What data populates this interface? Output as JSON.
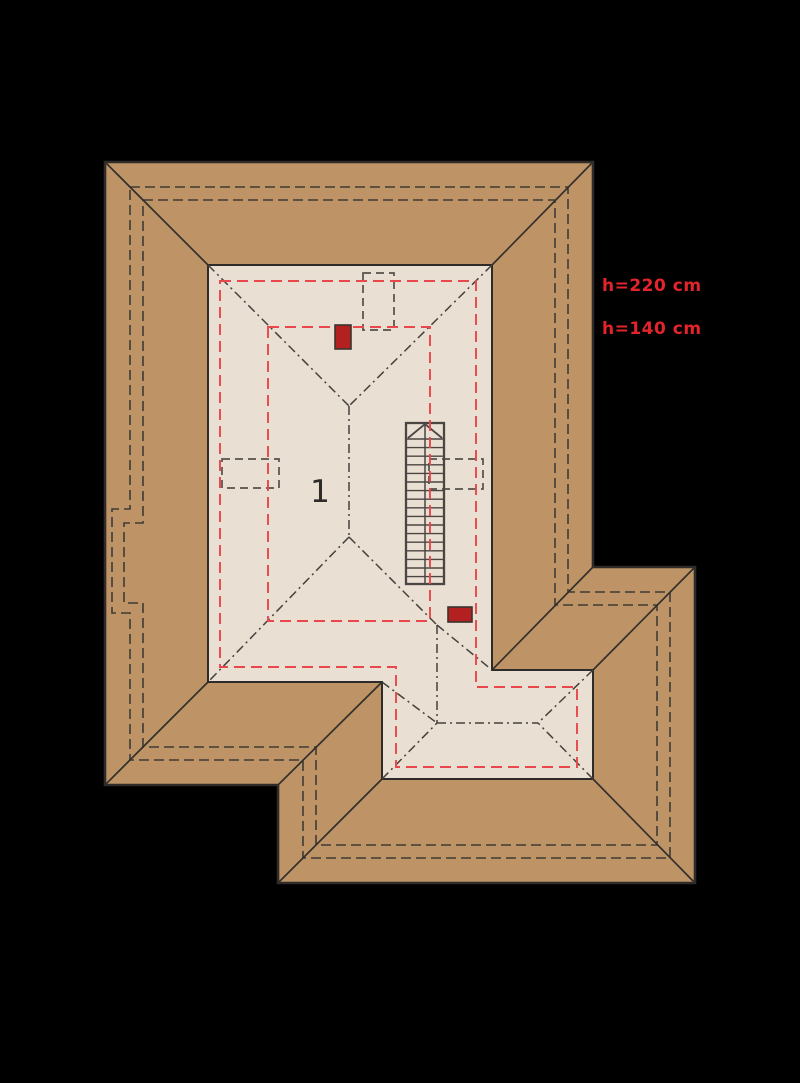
{
  "title": "Attic roof-level floor plan",
  "canvas": {
    "width": 800,
    "height": 1083,
    "background": "#000000"
  },
  "colors": {
    "roof_fill": "#BE9466",
    "floor_fill": "#EADFD3",
    "outline": "#2E2B28",
    "hip_line": "#33302C",
    "wall_dash": "#3E3B37",
    "ridge_dash": "#45413C",
    "window_dash": "#53504B",
    "height_line": "#E8474B",
    "annotation_text": "#E3242B",
    "room_label": "#2E2B28",
    "chimney_fill": "#B2211F",
    "chimney_stroke": "#3A3530",
    "stair_stroke": "#4A4642"
  },
  "annotations": {
    "height_upper": "h=220 cm",
    "height_lower": "h=140 cm",
    "room_number": "1"
  },
  "geometry": {
    "roof_outline": [
      [
        105,
        162
      ],
      [
        593,
        162
      ],
      [
        593,
        567
      ],
      [
        695,
        567
      ],
      [
        695,
        883
      ],
      [
        278,
        883
      ],
      [
        278,
        785
      ],
      [
        105,
        785
      ]
    ],
    "floor_outline": [
      [
        208,
        265
      ],
      [
        492,
        265
      ],
      [
        492,
        670
      ],
      [
        593,
        670
      ],
      [
        593,
        779
      ],
      [
        382,
        779
      ],
      [
        382,
        682
      ],
      [
        208,
        682
      ]
    ],
    "wall_outline_outer": [
      [
        130,
        187
      ],
      [
        568,
        187
      ],
      [
        568,
        592
      ],
      [
        670,
        592
      ],
      [
        670,
        858
      ],
      [
        303,
        858
      ],
      [
        303,
        760
      ],
      [
        130,
        760
      ],
      [
        130,
        613
      ],
      [
        112,
        613
      ],
      [
        112,
        509
      ],
      [
        130,
        509
      ]
    ],
    "wall_outline_inner": [
      [
        143,
        200
      ],
      [
        555,
        200
      ],
      [
        555,
        605
      ],
      [
        657,
        605
      ],
      [
        657,
        845
      ],
      [
        316,
        845
      ],
      [
        316,
        747
      ],
      [
        143,
        747
      ],
      [
        143,
        603
      ],
      [
        124,
        603
      ],
      [
        124,
        523
      ],
      [
        143,
        523
      ]
    ],
    "hip_valley_lines": [
      [
        [
          105,
          162
        ],
        [
          208,
          265
        ]
      ],
      [
        [
          593,
          162
        ],
        [
          492,
          265
        ]
      ],
      [
        [
          105,
          785
        ],
        [
          208,
          682
        ]
      ],
      [
        [
          278,
          785
        ],
        [
          382,
          682
        ]
      ],
      [
        [
          278,
          883
        ],
        [
          382,
          779
        ]
      ],
      [
        [
          695,
          883
        ],
        [
          593,
          779
        ]
      ],
      [
        [
          695,
          567
        ],
        [
          593,
          670
        ]
      ],
      [
        [
          593,
          567
        ],
        [
          492,
          670
        ]
      ]
    ],
    "ridge_projection_lines": [
      [
        [
          208,
          265
        ],
        [
          349,
          406
        ]
      ],
      [
        [
          492,
          265
        ],
        [
          349,
          406
        ]
      ],
      [
        [
          349,
          406
        ],
        [
          349,
          537
        ]
      ],
      [
        [
          349,
          537
        ],
        [
          208,
          682
        ]
      ],
      [
        [
          349,
          537
        ],
        [
          437,
          625
        ]
      ],
      [
        [
          437,
          625
        ],
        [
          437,
          723
        ]
      ],
      [
        [
          437,
          625
        ],
        [
          492,
          670
        ]
      ],
      [
        [
          382,
          682
        ],
        [
          437,
          723
        ]
      ],
      [
        [
          437,
          723
        ],
        [
          538,
          723
        ]
      ],
      [
        [
          382,
          779
        ],
        [
          437,
          723
        ]
      ],
      [
        [
          593,
          670
        ],
        [
          538,
          723
        ]
      ],
      [
        [
          593,
          779
        ],
        [
          538,
          723
        ]
      ]
    ],
    "height_line_outer": [
      [
        220,
        281
      ],
      [
        476,
        281
      ],
      [
        476,
        687
      ],
      [
        577,
        687
      ],
      [
        577,
        767
      ],
      [
        396,
        767
      ],
      [
        396,
        667
      ],
      [
        220,
        667
      ]
    ],
    "height_line_inner": [
      [
        268,
        327
      ],
      [
        430,
        327
      ],
      [
        430,
        621
      ],
      [
        268,
        621
      ]
    ],
    "roof_windows": [
      {
        "x": 363,
        "y": 273,
        "w": 31,
        "h": 57
      },
      {
        "x": 222,
        "y": 459,
        "w": 57,
        "h": 29
      },
      {
        "x": 429,
        "y": 459,
        "w": 54,
        "h": 30
      }
    ],
    "chimneys": [
      {
        "x": 335,
        "y": 325,
        "w": 16,
        "h": 24
      },
      {
        "x": 448,
        "y": 607,
        "w": 24,
        "h": 15
      }
    ],
    "stair": {
      "x": 406,
      "y": 423,
      "w": 38,
      "h": 161,
      "divider_x": 425,
      "tread_top": 439,
      "tread_bottom": 577,
      "tread_step": 8.6,
      "arrow": [
        [
          408,
          438
        ],
        [
          425,
          424
        ],
        [
          442,
          438
        ]
      ]
    },
    "label_positions": {
      "room_number": {
        "x": 320,
        "y": 502
      },
      "height_upper": {
        "x": 602,
        "y": 291
      },
      "height_lower": {
        "x": 602,
        "y": 334
      }
    }
  }
}
